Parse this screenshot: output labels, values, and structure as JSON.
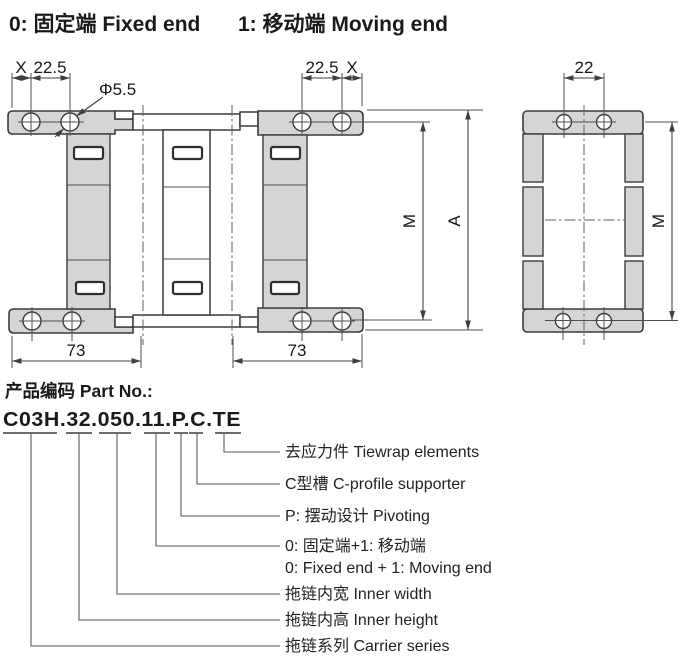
{
  "header": {
    "left": "0: 固定端 Fixed end",
    "right": "1: 移动端 Moving end"
  },
  "drawing": {
    "front": {
      "dim_x_left": "X",
      "dim_225_left": "22.5",
      "dim_dia": "Φ5.5",
      "dim_225_right": "22.5",
      "dim_x_right": "X",
      "dim_m": "M",
      "dim_a": "A",
      "dim_73_left": "73",
      "dim_73_right": "73"
    },
    "side": {
      "dim_22": "22",
      "dim_m": "M"
    }
  },
  "part_section": {
    "title": "产品编码 Part No.:",
    "part_number": "C03H.32.050.11.P.C.TE",
    "segments": [
      "C03H",
      "32",
      "050",
      "11",
      "P",
      "C",
      "TE"
    ],
    "callouts": [
      {
        "code": "TE",
        "label": "去应力件 Tiewrap elements"
      },
      {
        "code": "C",
        "label": "C型槽 C-profile supporter"
      },
      {
        "code": "P",
        "label": "P: 摆动设计 Pivoting"
      },
      {
        "code": "11",
        "label": "0: 固定端+1: 移动端",
        "label_en": "0: Fixed end + 1: Moving end"
      },
      {
        "code": "050",
        "label": "拖链内宽 Inner width"
      },
      {
        "code": "32",
        "label": "拖链内高 Inner height"
      },
      {
        "code": "C03H",
        "label": "拖链系列 Carrier series"
      }
    ]
  },
  "colors": {
    "background": "#ffffff",
    "part_fill": "#d4d5d7",
    "outline": "#3c3c3c",
    "text": "#1a1a1a"
  }
}
